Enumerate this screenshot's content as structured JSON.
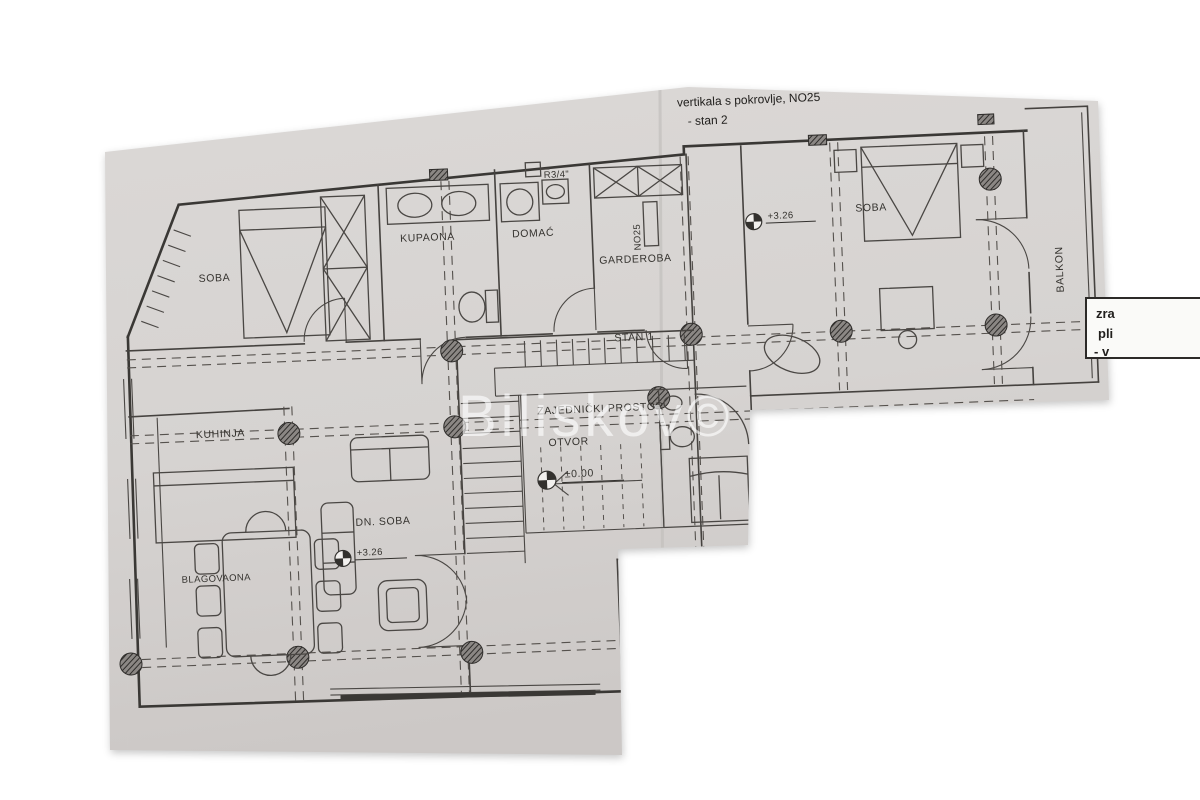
{
  "colors": {
    "background": "#ffffff",
    "paper": "#d8d5d3",
    "paper_dark": "#ccc9c7",
    "ink": "#3a3835",
    "watermark": "rgba(255,255,255,0.62)"
  },
  "annotations": {
    "top_line1": "vertikala s pokrovlje, NO25",
    "top_line2": "- stan 2",
    "stan1": "STAN 1",
    "no25": "NO25",
    "r34": "R3/4\"",
    "elev_upper": "+3.26",
    "elev_ground": "±0.00"
  },
  "rooms": {
    "soba_left": "SOBA",
    "kupaona": "KUPAONA",
    "domac": "DOMAĆ",
    "garderoba": "GARDEROBA",
    "soba_right": "SOBA",
    "balkon": "BALKON",
    "kuhinja": "KUHINJA",
    "blagovaona": "BLAGOVAONA",
    "dn_soba": "DN. SOBA",
    "zajednicki_prostor": "ZAJEDNIČKI PROSTOR",
    "otvor": "OTVOR"
  },
  "legend_box": {
    "lines": [
      "zra",
      "pli",
      "- v"
    ]
  },
  "watermark": {
    "text": "Biliskov©"
  }
}
